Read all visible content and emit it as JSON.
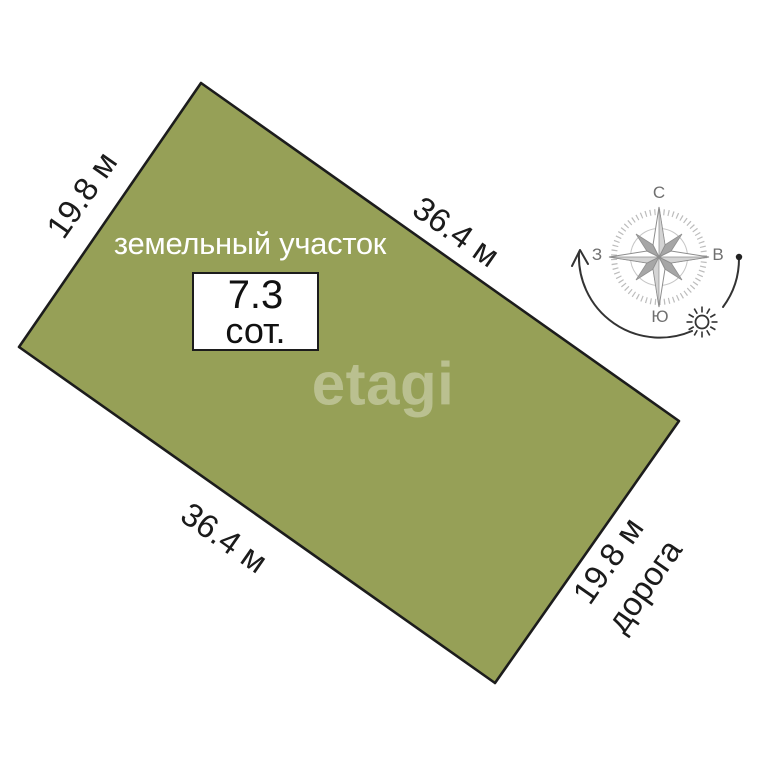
{
  "plot": {
    "label": "земельный участок",
    "area": {
      "value": "7.3",
      "unit": "сот."
    },
    "sides": {
      "left": "19.8 м",
      "top_right": "36.4 м",
      "bottom_left": "36.4 м",
      "right": "19.8 м",
      "right_road": "дорога"
    }
  },
  "compass": {
    "north": "С",
    "east": "В",
    "south": "Ю",
    "west": "З"
  },
  "watermark": {
    "text": "etagi"
  },
  "colors": {
    "plot_fill": "#96a057",
    "plot_border": "#1c1c1c",
    "dimension_text": "#1b1b1b",
    "plot_label_text": "#ffffff",
    "compass_label": "#6f6f6f",
    "compass_star_gray": "#a6a6a6",
    "sun_path": "#333333",
    "watermark_color": "rgba(255,255,255,0.34)",
    "background": "#ffffff"
  }
}
